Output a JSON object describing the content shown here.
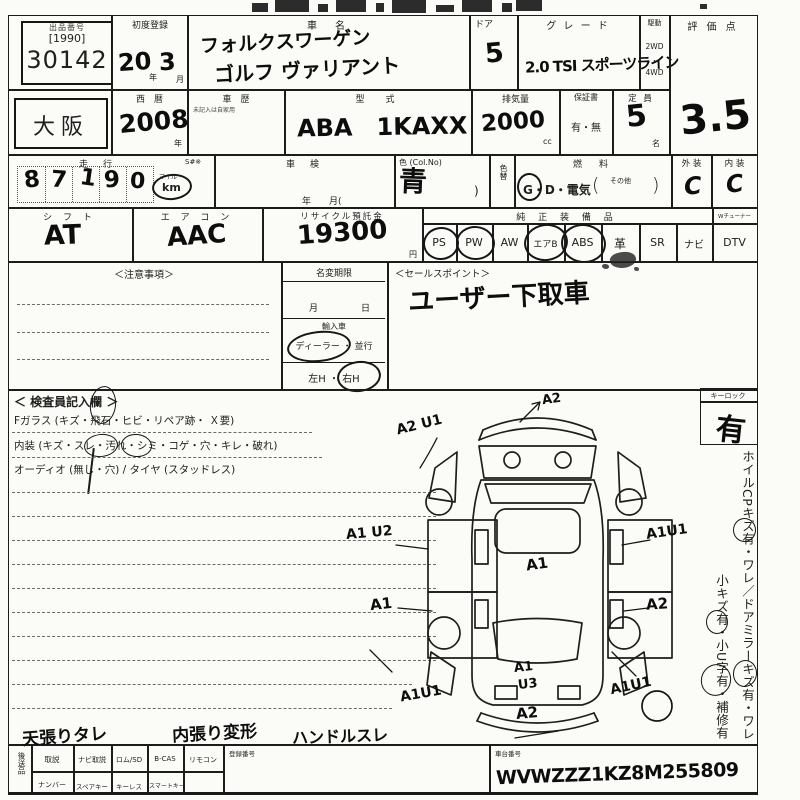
{
  "sheet": {
    "top": {
      "auction_label": "出品番号",
      "auction_bracket": "[1990]",
      "auction_no": "30142",
      "first_reg_label": "初度登録",
      "first_reg_year": "20",
      "year_suffix": "年",
      "first_reg_month": "3",
      "month_suffix": "月",
      "name_label": "車　名",
      "name_line1": "フォルクスワーゲン",
      "name_line2": "ゴルフ ヴァリアント",
      "door_label": "ドア",
      "door_value": "5",
      "grade_label": "グ レ ー ド",
      "grade_value": "2.0 TSI スポーツライン",
      "drive_label": "駆動",
      "drive_opt1": "2WD",
      "drive_dot": "・",
      "drive_opt2": "4WD",
      "score_label": "評 価 点",
      "score_value": "3.5"
    },
    "row2": {
      "region": "大阪",
      "year_label": "西　暦",
      "year_value": "2008",
      "year_suffix": "年",
      "history_label": "車　歴",
      "history_note": "未記入は自家用",
      "model_label": "型　式",
      "model_value": "ABA　1KAXX",
      "disp_label": "排気量",
      "disp_value": "2000",
      "disp_unit": "cc",
      "warranty_label": "保証書",
      "warranty_value": "有・無",
      "cap_label": "定 員",
      "cap_value": "5",
      "cap_unit": "名"
    },
    "row3": {
      "run_label": "走　行",
      "s_label": "S#※",
      "digits": [
        "8",
        "7",
        "1",
        "9",
        "0"
      ],
      "unit_top": "マイル",
      "unit_bottom": "km",
      "unit_selected": "km",
      "shaken_label": "車　検",
      "shaken_hint": "年　　月(",
      "color_label": "色 (Col.No)",
      "color_value": "青",
      "color_close": ")",
      "colorchg_label": "色替",
      "fuel_label": "燃　料",
      "fuel_options": "G・D・電気",
      "paren_open": "(",
      "fuel_other": "その他",
      "paren_close": ")",
      "fuel_selected": "G",
      "ext_label": "外 装",
      "ext_value": "C",
      "int_label": "内 装",
      "int_value": "C"
    },
    "row4": {
      "shift_label": "シ フ ト",
      "shift_value": "AT",
      "ac_label": "エ ア コ ン",
      "ac_value": "AAC",
      "recycle_label": "リサイクル預託金",
      "recycle_value": "19300",
      "recycle_unit": "円",
      "equip_label": "純 正 装 備 品",
      "tuner_label": "Wチューナー",
      "equips": [
        "PS",
        "PW",
        "AW",
        "エアB",
        "ABS",
        "革",
        "SR",
        "ナビ",
        "DTV"
      ],
      "equips_circled": [
        "PS",
        "PW",
        "エアB",
        "ABS"
      ]
    },
    "mid": {
      "caution_label": "＜注意事項＞",
      "namechg_label": "名変期限",
      "month_label": "月",
      "day_label": "日",
      "import_label": "輸入車",
      "import_options": "ディーラー ・ 並行",
      "import_selected": "ディーラー",
      "handle_options": "左H ・ 右H",
      "handle_selected": "右H",
      "sales_label": "＜セールスポイント＞",
      "sales_value": "ユーザー下取車"
    },
    "inspect": {
      "title": "＜ 検査員記入欄 ＞",
      "fglass_line": "Fガラス (キズ・飛石・ヒビ・リペア跡・ Ｘ要)",
      "interior_line": "内装 (キズ・スレ・汚れ・シミ・コゲ・穴・キレ・破れ)",
      "interior_circled": [
        "スレ",
        "汚れ"
      ],
      "audio_line": "オーディオ (無し・穴) / タイヤ (スタッドレス)",
      "keylock_label": "キーロック",
      "keylock_value": "有",
      "side_note_right": "ホイルCPキズ有・ワレ／ドアミラーキズ有・ワレ",
      "side_note_left": "小キズ有・小U字有・補修有"
    },
    "diagram": {
      "labels": [
        "A2",
        "A2 U1",
        "A1 U2",
        "A1",
        "A1U1",
        "A1",
        "A2",
        "A1U1",
        "A1U1",
        "A1",
        "U3",
        "A2"
      ]
    },
    "bottom": {
      "notes": [
        "天張りタレ",
        "内張り変形",
        "ハンドルスレ"
      ],
      "later_label": "後送品",
      "row1": [
        "取説",
        "ナビ取説",
        "ロム/SD",
        "B-CAS",
        "リモコン"
      ],
      "row2": [
        "ナンバー",
        "スペアキー",
        "キーレス",
        "スマートキー"
      ],
      "reg_label": "登録番号",
      "vin_label": "車台番号",
      "vin_value": "WVWZZZ1KZ8M255809"
    }
  }
}
